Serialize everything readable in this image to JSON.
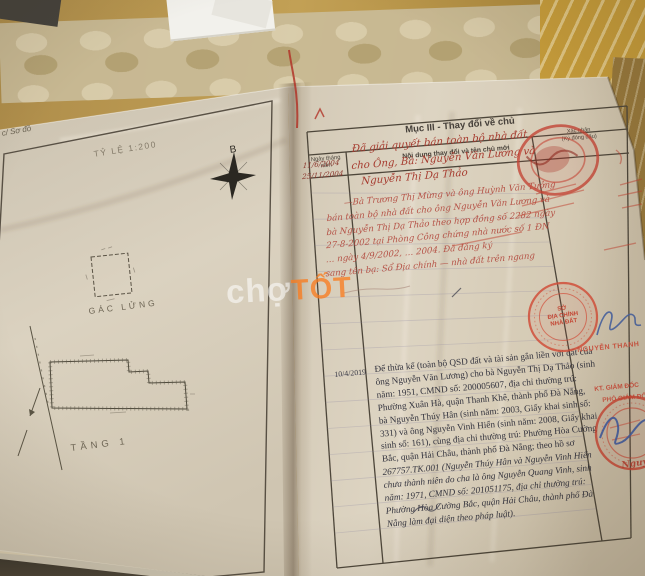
{
  "watermark": {
    "white": "chợ",
    "orange": "TỐT"
  },
  "left_page": {
    "corner_label": "c/ Sơ đồ",
    "scale_label": "TỶ LỆ 1:200",
    "compass_north": "B",
    "mezzanine_label": "GÁC LỬNG",
    "floor_label": "TẦNG 1"
  },
  "right_page": {
    "section_title": "Mục III - Thay đổi về chủ",
    "col_date": "Ngày tháng\nnăm",
    "col_content": "Nội dung thay đổi và tên chủ mới",
    "col_confirm": "Xác nhận\n(Ký đóng dấu)",
    "entry1_dates": "11/6/2004\n25/11/2004",
    "entry1_text": "Đã giải quyết bán toàn bộ nhà đất\ncho Ông, Bà: Nguyễn Văn Lương và\n Nguyễn Thị Dạ Thảo",
    "entry2_text": "  —Bà Trương Thị Mừng và ông Huỳnh Văn Tưởng\nbán toàn bộ nhà đất cho ông Nguyễn Văn Lương và\nbà Nguyễn Thị Dạ Thảo theo hợp đồng số 2282 ngày\n27-8-2002 tại Phòng Công chứng nhà nước số 1 ĐN\n… ngày 4/9/2002, … 2004. Đã đăng ký\nsang tên bạ: Sổ Địa chính — nhà đất trên ngang",
    "entry3_date": "10/4/2019",
    "entry3_text_a": "Để thừa kế (toàn bộ QSD đất và tài sản gắn liền với đất của\nông Nguyễn Văn Lương) cho bà Nguyễn Thị Dạ Thảo (sinh\nnăm: 1951, CMND số: 200005607, địa chỉ thường trú:\nPhường Xuân Hà, quận Thanh Khê, thành phố Đà Nẵng,\nbà Nguyễn Thúy Hân (sinh năm: 2003, Giấy khai sinh số:\n331) và ông Nguyễn Vinh Hiển (sinh năm: 2008, Giấy khai\nsinh số: 161), cùng địa chỉ thường trú: Phường Hòa Cường\nBắc, quận Hải Châu, thành phố Đà Nẵng; theo hồ sơ",
    "entry3_text_b": "267757.TK.001 (Nguyễn Thúy Hân và Nguyễn Vinh Hiển\nchưa thành niên do cha là ông Nguyễn Quang Vinh, sinh\nnăm: 1971, CMND số: 201051175, địa chỉ thường trú:\nPhường Hòa Cường Bắc, quận Hải Châu, thành phố Đà\nNẵng làm đại diện theo pháp luật)."
  },
  "stamps": {
    "office_circle": "SỞ\nĐỊA CHÍNH\nNHÀ ĐẤT",
    "officer_name": "NGUYỄN THANH",
    "kt_title": "KT. GIÁM ĐỐC",
    "deputy_title": "PHÓ GIÁM ĐỐC",
    "signature_fragment": "Nguy"
  },
  "ink_colors": {
    "red_ink": "#b0453a",
    "blue_ink": "#44609a",
    "stamp_red": "#cf4a38",
    "typed_ink": "#34343d",
    "watermark_orange": "#f4762a"
  }
}
